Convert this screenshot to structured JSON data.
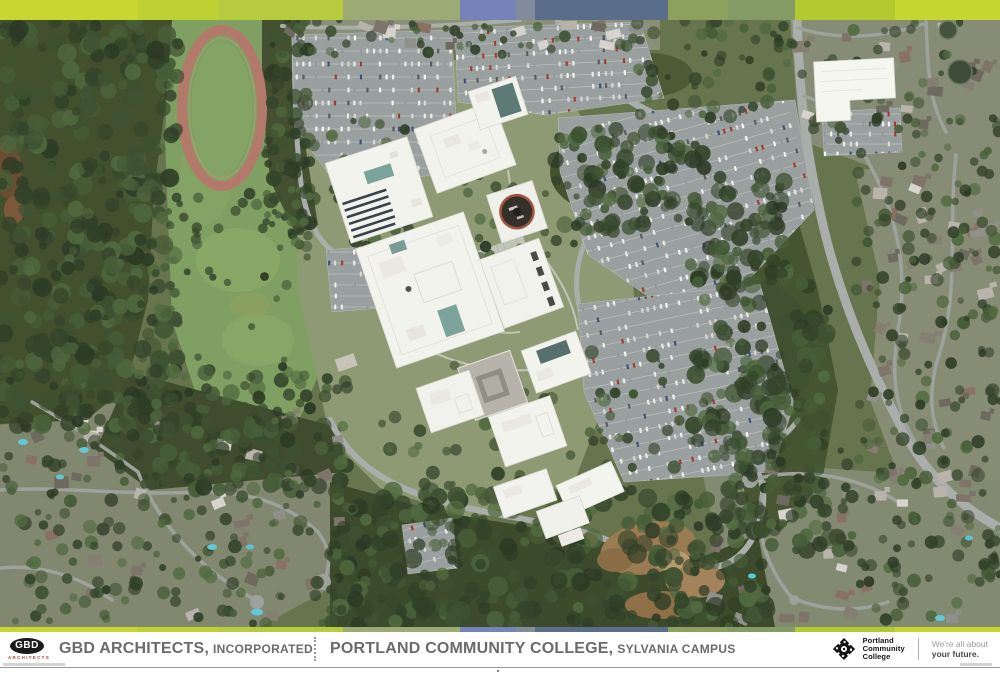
{
  "banner": {
    "stripes": [
      {
        "color": "#c9d62f",
        "width": 138
      },
      {
        "color": "#bdd232",
        "width": 80
      },
      {
        "color": "#b7cb3e",
        "width": 125
      },
      {
        "color": "#9cab76",
        "width": 117
      },
      {
        "color": "#7583b8",
        "width": 56
      },
      {
        "color": "#828b9b",
        "width": 19
      },
      {
        "color": "#5a6d8a",
        "width": 133
      },
      {
        "color": "#8da15f",
        "width": 60
      },
      {
        "color": "#859b66",
        "width": 67
      },
      {
        "color": "#b3c930",
        "width": 100
      },
      {
        "color": "#c5d62e",
        "width": 105
      }
    ]
  },
  "footer": {
    "left": {
      "logo_acronym": "GBD",
      "logo_subtitle": "ARCHITECTS",
      "firm_name": "GBD ARCHITECTS,",
      "firm_suffix": "INCORPORATED"
    },
    "center": {
      "project_name": "PORTLAND COMMUNITY COLLEGE,",
      "project_campus": "SYLVANIA CAMPUS"
    },
    "right": {
      "org_lines": [
        "Portland",
        "Community",
        "College"
      ],
      "tagline_light": "We're all about",
      "tagline_bold": "your future."
    }
  },
  "colors": {
    "gbd_red": "#b5413a",
    "footer_text_gray": "#6a6b6d",
    "pcc_black": "#141414"
  }
}
